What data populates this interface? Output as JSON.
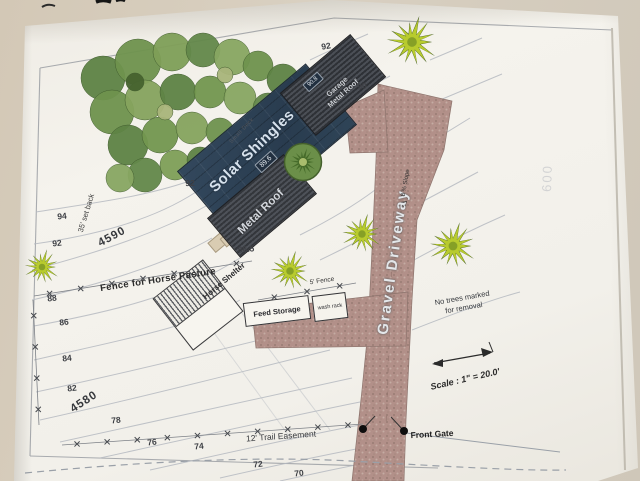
{
  "site_plan": {
    "buildings": {
      "solar_shingles_label": "Solar Shingles",
      "metal_roof_label": "Metal Roof",
      "garage_roof_label": "Garage Metal Roof",
      "small_deck_label": "Small Deck",
      "house_pad_elevation": "89.6",
      "garage_pad_elevation": "90.8",
      "horse_shelter_label": "Horse Shelter",
      "feed_storage_label": "Feed Storage",
      "wash_rack_label": "wash rack"
    },
    "site": {
      "gravel_driveway_label": "Gravel Driveway",
      "slope_label": "8 % Slope",
      "fence_pasture_label": "Fence for Horse Pasture",
      "fence_5ft_label": "5' Fence",
      "setback_label": "35' set back",
      "trail_easement_label": "12' Trail Easement",
      "front_gate_label": "Front Gate",
      "no_trees_note": "No trees marked for removal",
      "scale_label": "Scale : 1\" = 20.0'",
      "faint_background_mark": "600"
    },
    "contour_labels": [
      {
        "text": "94",
        "x": 62,
        "y": 216,
        "rot": -6
      },
      {
        "text": "92",
        "x": 57,
        "y": 243,
        "rot": -6
      },
      {
        "text": "4590",
        "x": 112,
        "y": 237,
        "rot": -28,
        "big": true
      },
      {
        "text": "88",
        "x": 52,
        "y": 298,
        "rot": -6
      },
      {
        "text": "86",
        "x": 64,
        "y": 322,
        "rot": -6
      },
      {
        "text": "84",
        "x": 67,
        "y": 358,
        "rot": -6
      },
      {
        "text": "82",
        "x": 72,
        "y": 388,
        "rot": -6
      },
      {
        "text": "4580",
        "x": 84,
        "y": 402,
        "rot": -33,
        "big": true
      },
      {
        "text": "78",
        "x": 116,
        "y": 420,
        "rot": -6
      },
      {
        "text": "76",
        "x": 152,
        "y": 442,
        "rot": -6
      },
      {
        "text": "74",
        "x": 199,
        "y": 446,
        "rot": -6
      },
      {
        "text": "72",
        "x": 258,
        "y": 464,
        "rot": -6
      },
      {
        "text": "70",
        "x": 299,
        "y": 473,
        "rot": -6
      },
      {
        "text": "92",
        "x": 190,
        "y": 183,
        "rot": -2
      },
      {
        "text": "92",
        "x": 326,
        "y": 46,
        "rot": -10
      },
      {
        "text": "90",
        "x": 362,
        "y": 86,
        "rot": -10
      },
      {
        "text": "86.5",
        "x": 246,
        "y": 249,
        "rot": -5
      }
    ],
    "colors": {
      "solar_roof": "#2e4256",
      "metal_roof": "#3b3e44",
      "driveway": "#b2948b",
      "tree_green": "#6f934e",
      "starburst_tree": "#b8cb2e",
      "paper": "#f3f1eb"
    }
  }
}
